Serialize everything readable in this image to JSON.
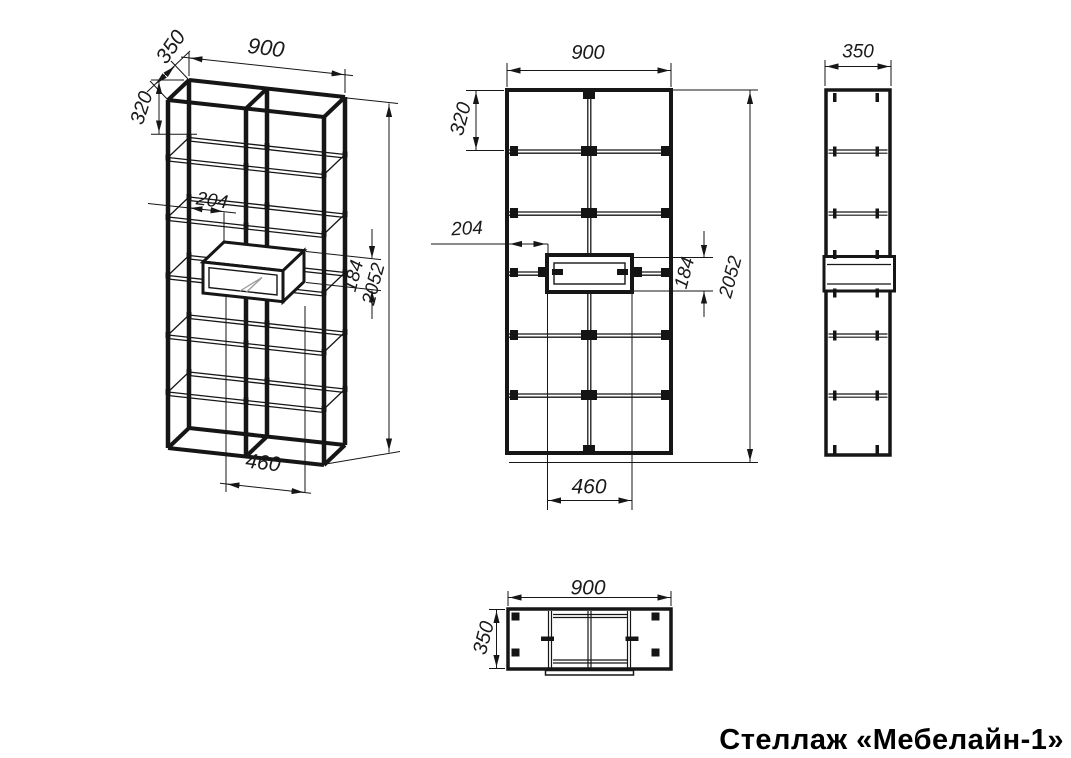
{
  "title": "Стеллаж «Мебелайн-1»",
  "drawing": {
    "views": {
      "isometric": {
        "dims": {
          "width": "900",
          "depth": "350",
          "top_section": "320",
          "niche_offset": "204",
          "niche_height": "184",
          "height": "2052",
          "niche_width": "460"
        }
      },
      "front": {
        "dims": {
          "width": "900",
          "top_section": "320",
          "niche_offset": "204",
          "niche_height": "184",
          "height": "2052",
          "niche_width": "460"
        }
      },
      "side": {
        "dims": {
          "depth": "350"
        }
      },
      "top": {
        "dims": {
          "width": "900",
          "depth": "350"
        }
      }
    }
  }
}
